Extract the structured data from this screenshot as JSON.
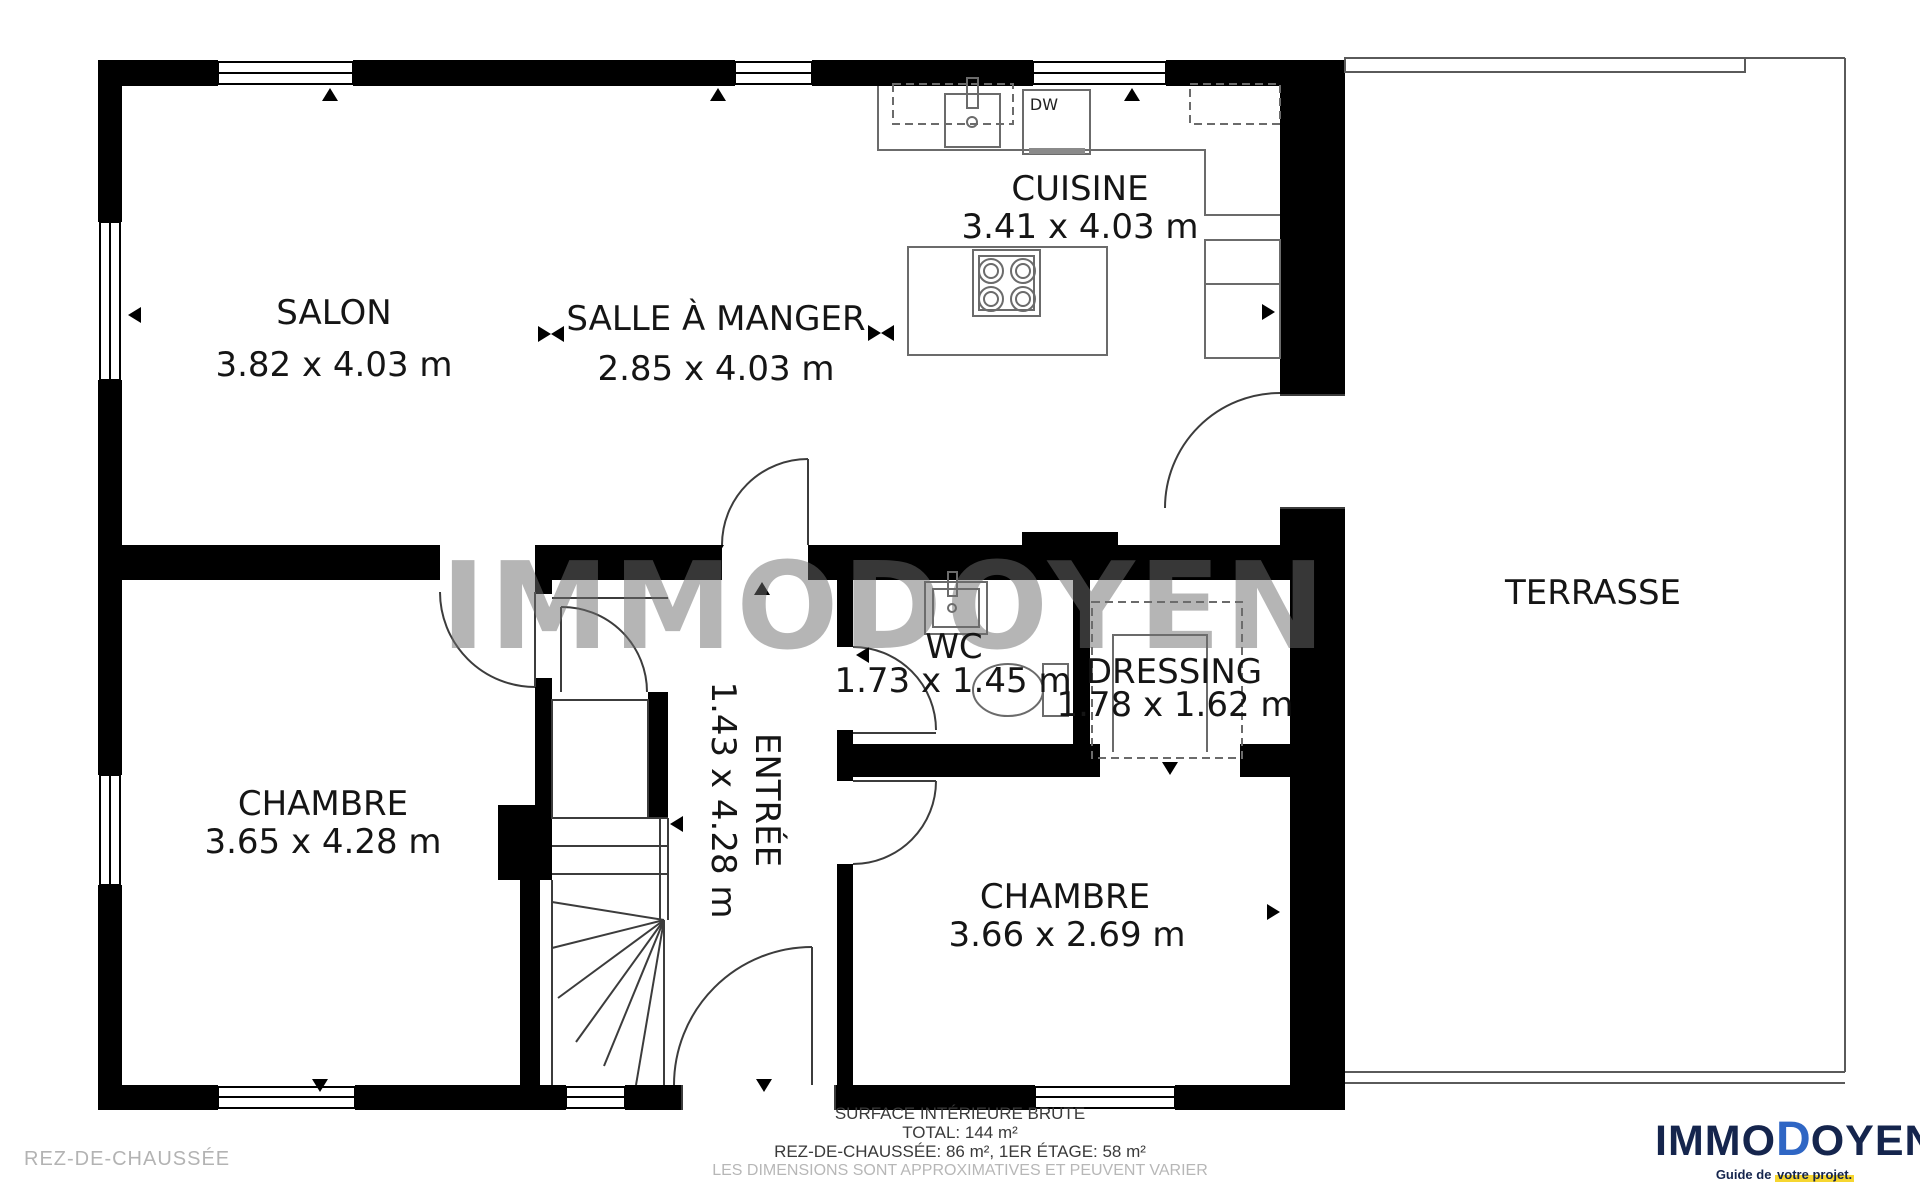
{
  "watermark": "IMMODOYEN",
  "floor_label": "REZ-DE-CHAUSSÉE",
  "rooms": {
    "salon": {
      "name": "SALON",
      "dims": "3.82 x 4.03 m"
    },
    "salle_a_manger": {
      "name": "SALLE À MANGER",
      "dims": "2.85 x 4.03 m"
    },
    "cuisine": {
      "name": "CUISINE",
      "dims": "3.41 x 4.03 m"
    },
    "terrasse": {
      "name": "TERRASSE"
    },
    "chambre_1": {
      "name": "CHAMBRE",
      "dims": "3.65 x 4.28 m"
    },
    "entree": {
      "name": "ENTRÉE",
      "dims": "1.43 x 4.28 m"
    },
    "wc": {
      "name": "WC",
      "dims": "1.73 x 1.45 m"
    },
    "dressing": {
      "name": "DRESSING",
      "dims": "1.78 x 1.62 m"
    },
    "chambre_2": {
      "name": "CHAMBRE",
      "dims": "3.66 x 2.69 m"
    }
  },
  "appliances": {
    "dishwasher": "DW"
  },
  "footer": {
    "line1": "SURFACE INTÉRIEURE BRUTE",
    "line2": "TOTAL: 144 m²",
    "line3": "REZ-DE-CHAUSSÉE: 86 m², 1ER ÉTAGE: 58 m²",
    "line4": "LES DIMENSIONS SONT APPROXIMATIVES ET PEUVENT VARIER"
  },
  "logo": {
    "part1": "IMMO",
    "part2": "D",
    "part3": "OYEN",
    "reg": "®",
    "tagline_prefix": "Guide de ",
    "tagline_highlight": "votre projet."
  },
  "colors": {
    "wall": "#000000",
    "line": "#3c3c3c",
    "fixture": "#6b6b6b",
    "accent_blue": "#2f66c4",
    "navy": "#15254d",
    "highlight": "#f6d630",
    "muted": "#b5b5b5"
  }
}
